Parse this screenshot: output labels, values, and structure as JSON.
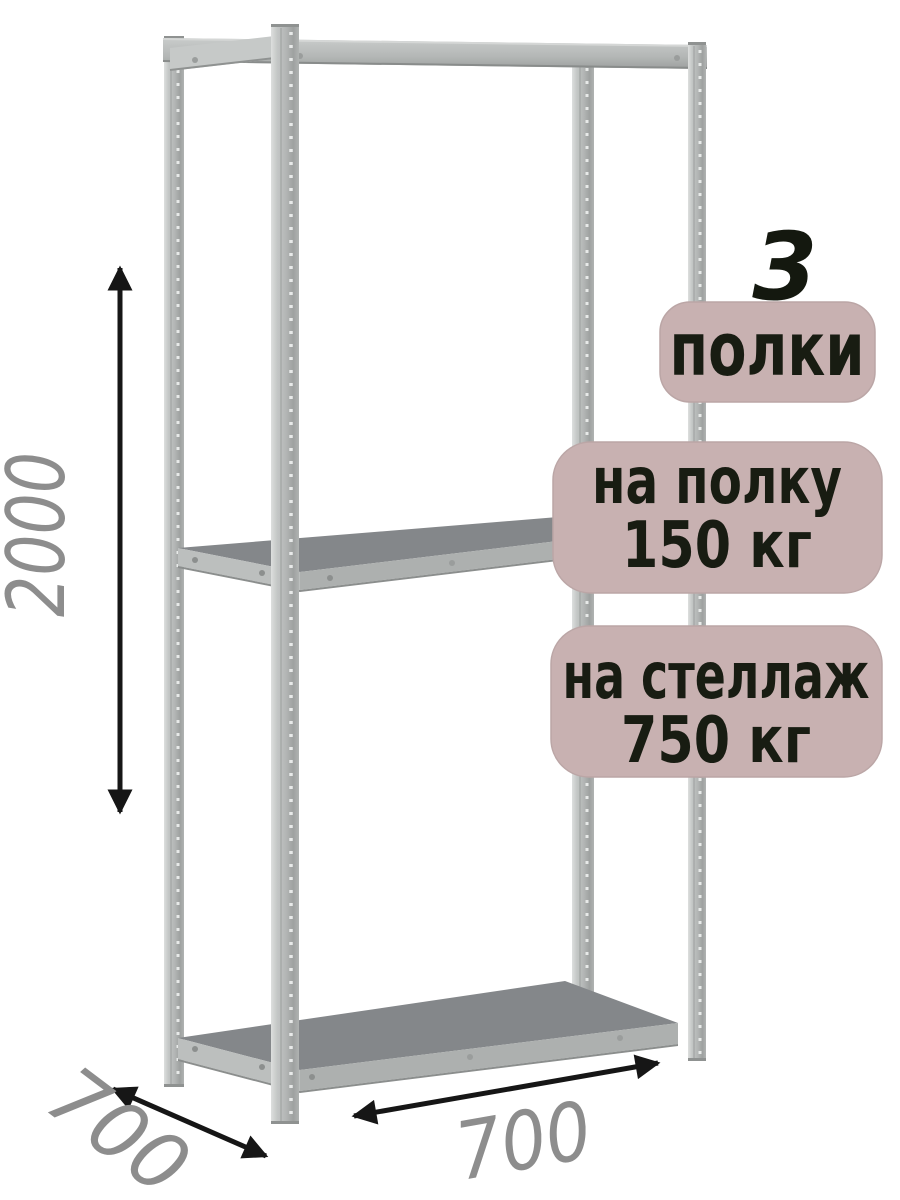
{
  "badges": {
    "shelves_count": "3",
    "shelves_label": "полки",
    "shelf_load": {
      "line1": "на полку",
      "line2": "150 кг"
    },
    "rack_load": {
      "line1": "на стеллаж",
      "line2": "750 кг"
    }
  },
  "dimensions": {
    "height_mm": "2000",
    "depth_mm": "700",
    "width_mm": "700"
  },
  "colors": {
    "badge_bg": "#c8b1b1",
    "badge_border": "#bba6a6",
    "badge_text": "#181c12",
    "count_text": "#14180f",
    "dimension_text": "#8d8d8d",
    "arrow": "#161616",
    "shelf_top": "#84878a",
    "shelf_face": "#adb0af",
    "metal_light": "#c6c9c8"
  }
}
